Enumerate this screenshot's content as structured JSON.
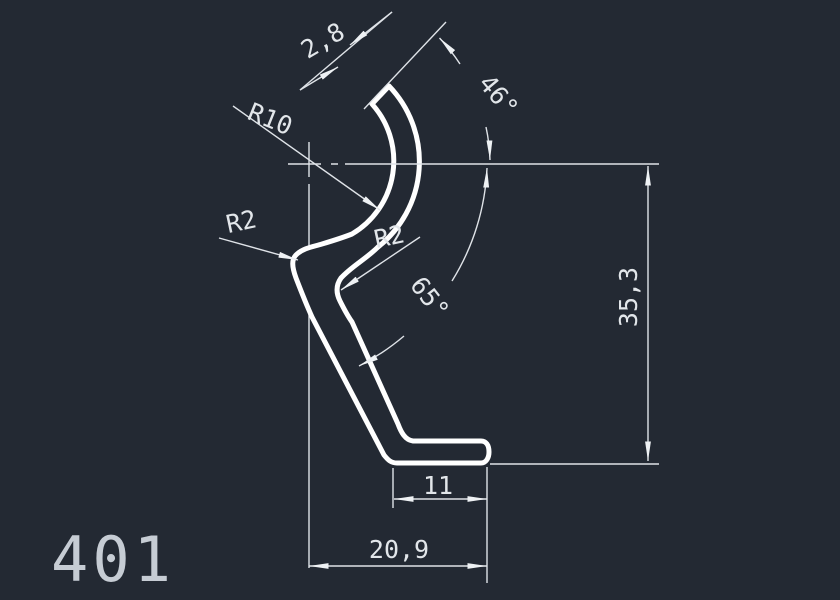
{
  "drawing": {
    "part_number": "401",
    "background_color": "#232933",
    "profile_line_color": "#ffffff",
    "dimension_line_color": "#dfe3e8",
    "text_color": "#e2e6ea",
    "annotations": {
      "wall_thickness": "2,8",
      "top_angle": "46°",
      "main_radius": "R10",
      "left_fillet_radius": "R2",
      "right_fillet_radius": "R2",
      "leg_angle": "65°",
      "overall_height": "35,3",
      "foot_width": "11",
      "overall_width": "20,9"
    }
  }
}
